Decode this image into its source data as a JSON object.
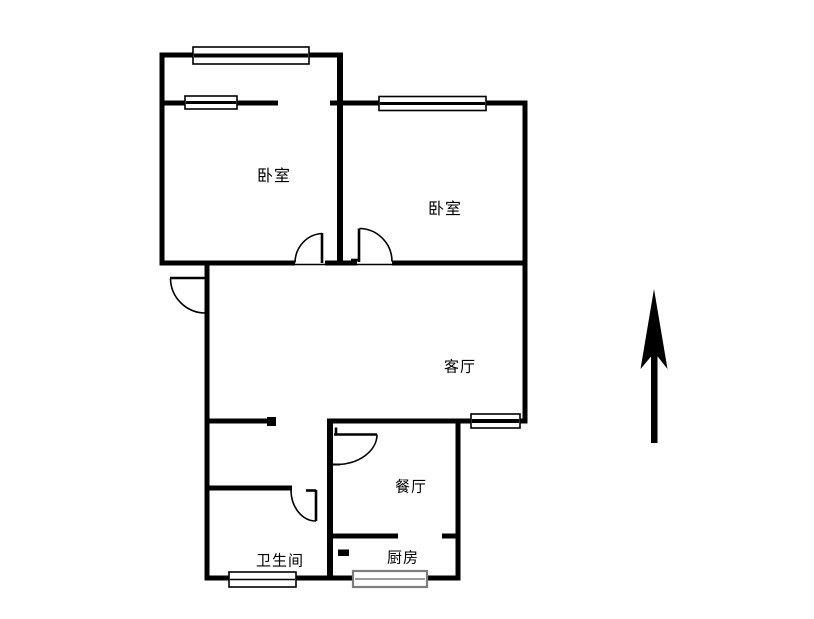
{
  "diagram_type": "residential-floor-plan",
  "rooms": {
    "bedroom1": {
      "label": "卧室"
    },
    "bedroom2": {
      "label": "卧室"
    },
    "living_room": {
      "label": "客厅"
    },
    "dining_room": {
      "label": "餐厅"
    },
    "bathroom": {
      "label": "卫生间"
    },
    "kitchen": {
      "label": "厨房"
    }
  },
  "features": {
    "windows": [
      "balcony-bay-window",
      "bedroom1-inner-window",
      "bedroom2-window",
      "living-room-window",
      "bathroom-window",
      "kitchen-window"
    ],
    "doors": [
      "entry-door",
      "bedroom1-door",
      "bedroom2-door",
      "dining-room-door",
      "bathroom-door"
    ],
    "compass_arrow_points": "north"
  },
  "colors": {
    "wall": "#000000",
    "background": "#ffffff",
    "kitchen_window_border": "#7d7d7d"
  }
}
